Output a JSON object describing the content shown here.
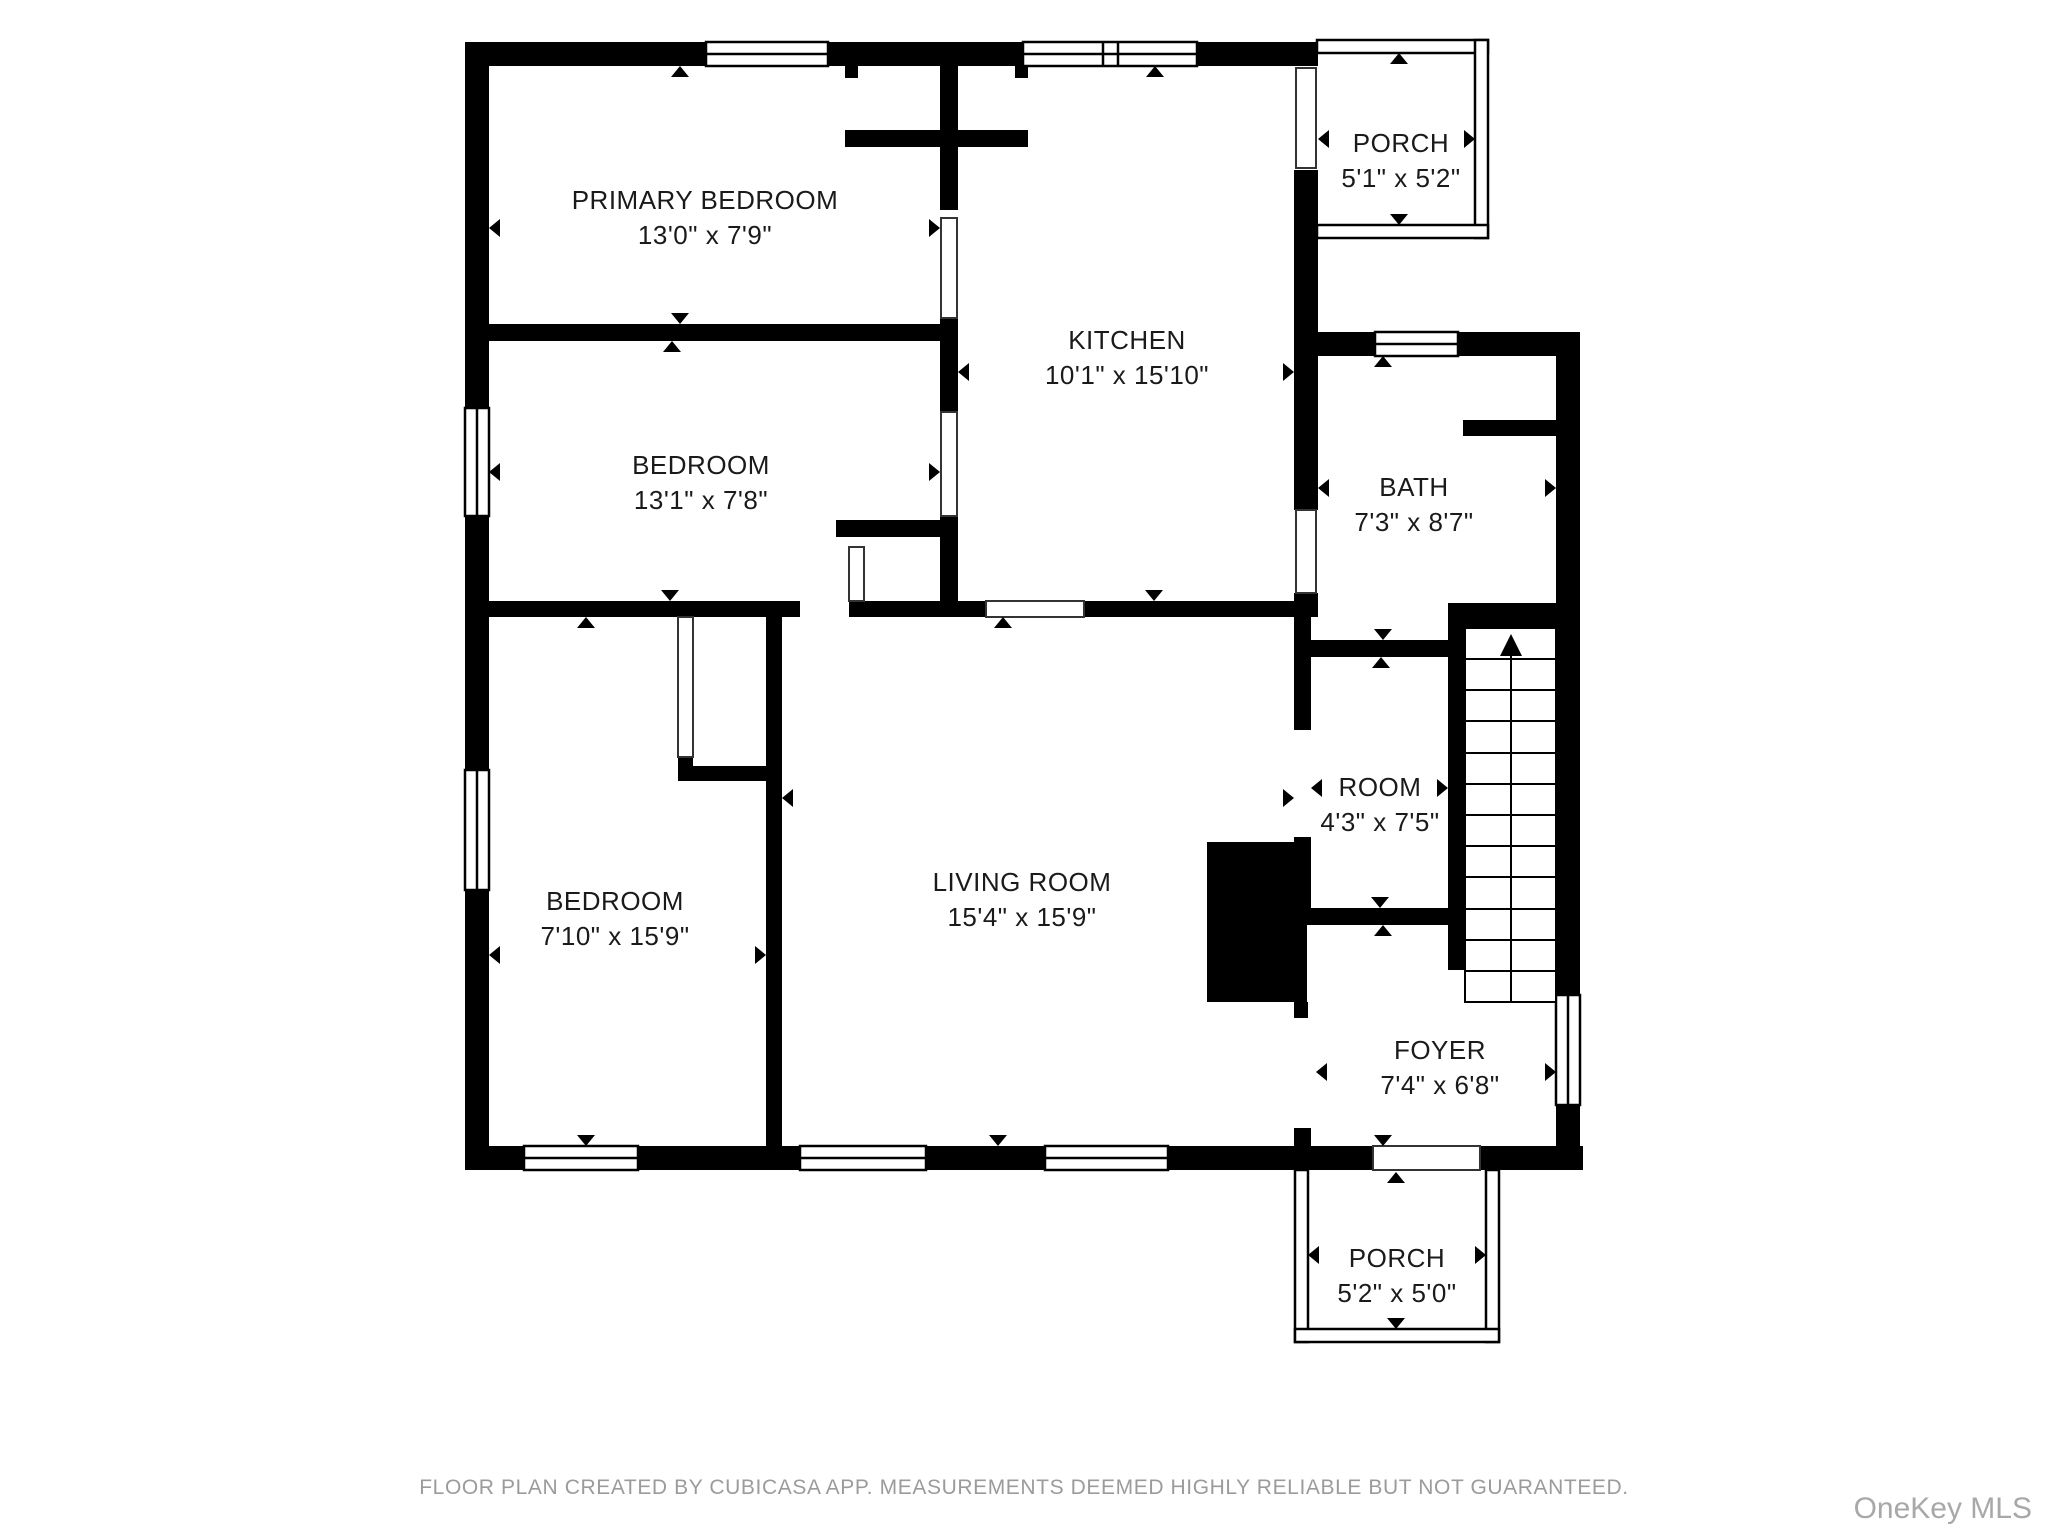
{
  "rooms": [
    {
      "name": "PRIMARY BEDROOM",
      "dims": "13'0\" x 7'9\""
    },
    {
      "name": "BEDROOM",
      "dims": "13'1\" x 7'8\""
    },
    {
      "name": "KITCHEN",
      "dims": "10'1\" x 15'10\""
    },
    {
      "name": "PORCH",
      "dims": "5'1\" x 5'2\""
    },
    {
      "name": "BATH",
      "dims": "7'3\" x 8'7\""
    },
    {
      "name": "ROOM",
      "dims": "4'3\" x 7'5\""
    },
    {
      "name": "LIVING ROOM",
      "dims": "15'4\" x 15'9\""
    },
    {
      "name": "BEDROOM",
      "dims": "7'10\" x 15'9\""
    },
    {
      "name": "FOYER",
      "dims": "7'4\" x 6'8\""
    },
    {
      "name": "PORCH",
      "dims": "5'2\" x 5'0\""
    }
  ],
  "footer": {
    "disclaimer": "FLOOR PLAN CREATED BY CUBICASA APP. MEASUREMENTS DEEMED HIGHLY RELIABLE BUT NOT GUARANTEED."
  },
  "watermark": {
    "text": "OneKey MLS"
  },
  "colors": {
    "wall": "#000000",
    "background": "#ffffff",
    "label_text": "#1a1a1a",
    "footer_text": "#9b9b9b",
    "watermark_text": "#a8a8a8"
  }
}
